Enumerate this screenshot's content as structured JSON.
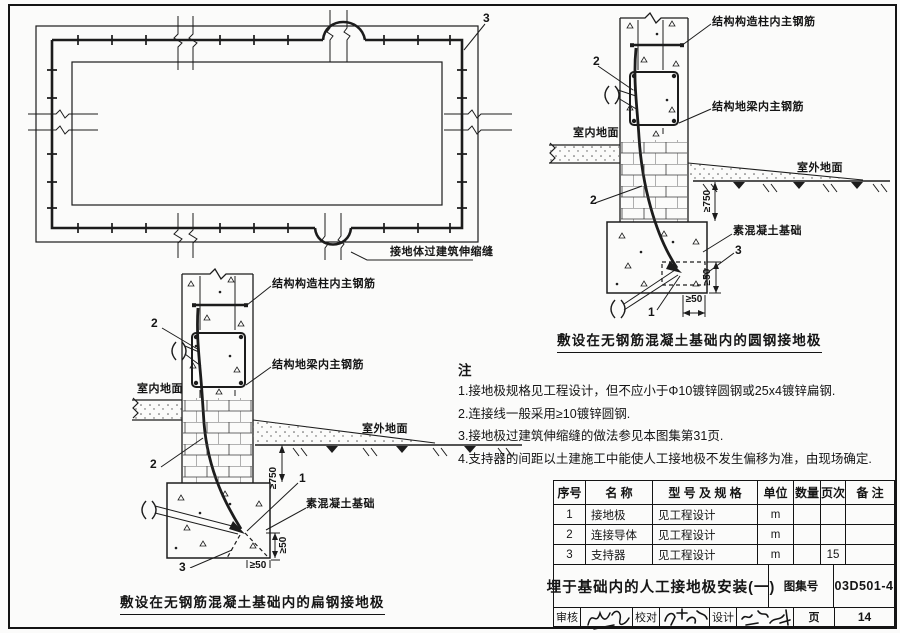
{
  "plan_view": {
    "callout_3": "3",
    "expansion_joint_label": "接地体过建筑伸缩缝"
  },
  "flat_detail": {
    "caption": "敷设在无钢筋混凝土基础内的扁钢接地极",
    "column_rebar_label": "结构构造柱内主钢筋",
    "beam_rebar_label": "结构地梁内主钢筋",
    "indoor_ground_label": "室内地面",
    "outdoor_ground_label": "室外地面",
    "footing_label": "素混凝土基础",
    "dim_depth": "≥750",
    "dim_cover_vertical": "≥50",
    "dim_cover_horizontal": "≥50",
    "callout_1": "1",
    "callout_2_upper": "2",
    "callout_2_lower": "2",
    "callout_3": "3"
  },
  "round_detail": {
    "caption": "敷设在无钢筋混凝土基础内的圆钢接地极",
    "column_rebar_label": "结构构造柱内主钢筋",
    "beam_rebar_label": "结构地梁内主钢筋",
    "indoor_ground_label": "室内地面",
    "outdoor_ground_label": "室外地面",
    "footing_label": "素混凝土基础",
    "dim_depth": "≥750",
    "dim_cover_vertical": "≥50",
    "dim_cover_horizontal": "≥50",
    "callout_1": "1",
    "callout_2_upper": "2",
    "callout_2_lower": "2",
    "callout_3": "3"
  },
  "notes": {
    "title": "注",
    "items": [
      "1.接地极规格见工程设计，但不应小于Φ10镀锌圆钢或25x4镀锌扁钢.",
      "2.连接线一般采用≥10镀锌圆钢.",
      "3.接地极过建筑伸缩缝的做法参见本图集第31页.",
      "4.支持器的间距以土建施工中能使人工接地极不发生偏移为准，由现场确定."
    ]
  },
  "materials_table": {
    "headers": [
      "序号",
      "名  称",
      "型 号 及 规 格",
      "单位",
      "数量",
      "页次",
      "备 注"
    ],
    "rows": [
      [
        "1",
        "接地极",
        "见工程设计",
        "m",
        "",
        "",
        ""
      ],
      [
        "2",
        "连接导体",
        "见工程设计",
        "m",
        "",
        "",
        ""
      ],
      [
        "3",
        "支持器",
        "见工程设计",
        "m",
        "",
        "15",
        ""
      ]
    ]
  },
  "title_block": {
    "title": "埋于基础内的人工接地极安装(一)",
    "atlas_label": "图集号",
    "atlas_number": "03D501-4",
    "page_label": "页",
    "page_number": "14",
    "review_label": "审核",
    "proof_label": "校对",
    "design_label": "设计"
  }
}
